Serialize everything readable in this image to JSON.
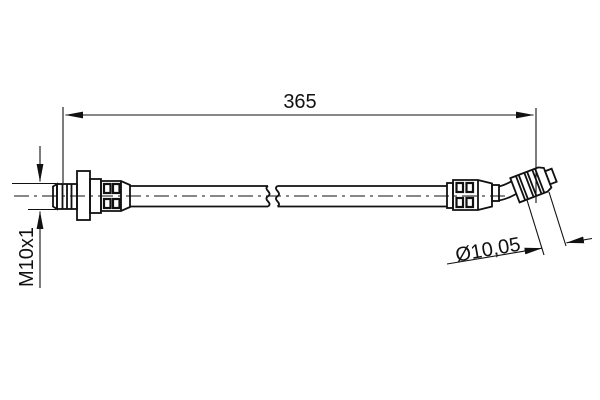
{
  "drawing": {
    "background_color": "#ffffff",
    "line_color": "#111111",
    "dimensions": {
      "length": "365",
      "thread": "M10x1",
      "diameter": "Ø10,05"
    }
  }
}
